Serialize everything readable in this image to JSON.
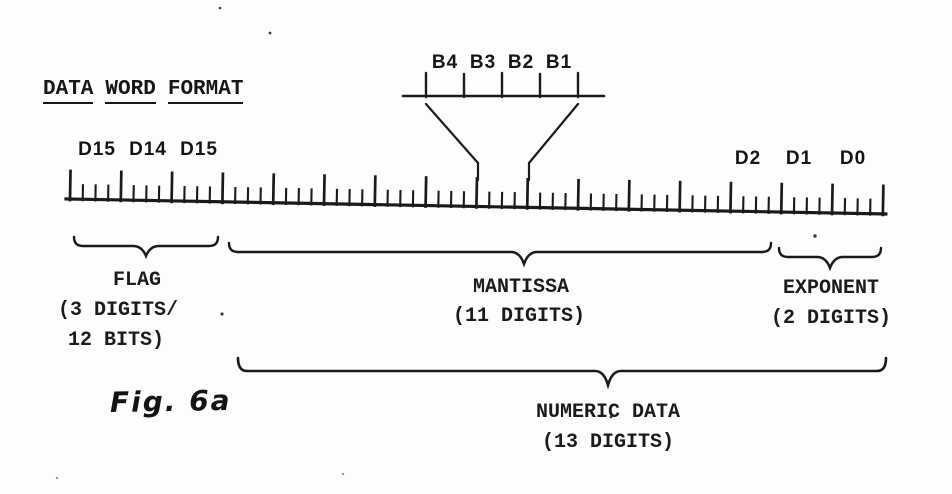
{
  "figure": {
    "title_words": [
      "DATA",
      "WORD",
      "FORMAT"
    ],
    "fig_label": "Fig. 6a"
  },
  "colors": {
    "ink": "#1a1a1a",
    "paper": "#fdfdfb"
  },
  "bit_scale": {
    "labels": [
      "B4",
      "B3",
      "B2",
      "B1"
    ]
  },
  "ruler": {
    "digits": 16,
    "bits_per_digit": 4,
    "left_digit_labels": [
      "D15",
      "D14",
      "D15"
    ],
    "right_digit_labels": [
      "D2",
      "D1",
      "D0"
    ]
  },
  "sections": [
    {
      "id": "flag",
      "label": "FLAG",
      "detail1": "(3 DIGITS/",
      "detail2": "12 BITS)"
    },
    {
      "id": "mantissa",
      "label": "MANTISSA",
      "detail1": "(11 DIGITS)"
    },
    {
      "id": "exponent",
      "label": "EXPONENT",
      "detail1": "(2 DIGITS)"
    },
    {
      "id": "numeric-data",
      "label": "NUMERIC DATA",
      "detail1": "(13 DIGITS)"
    }
  ]
}
